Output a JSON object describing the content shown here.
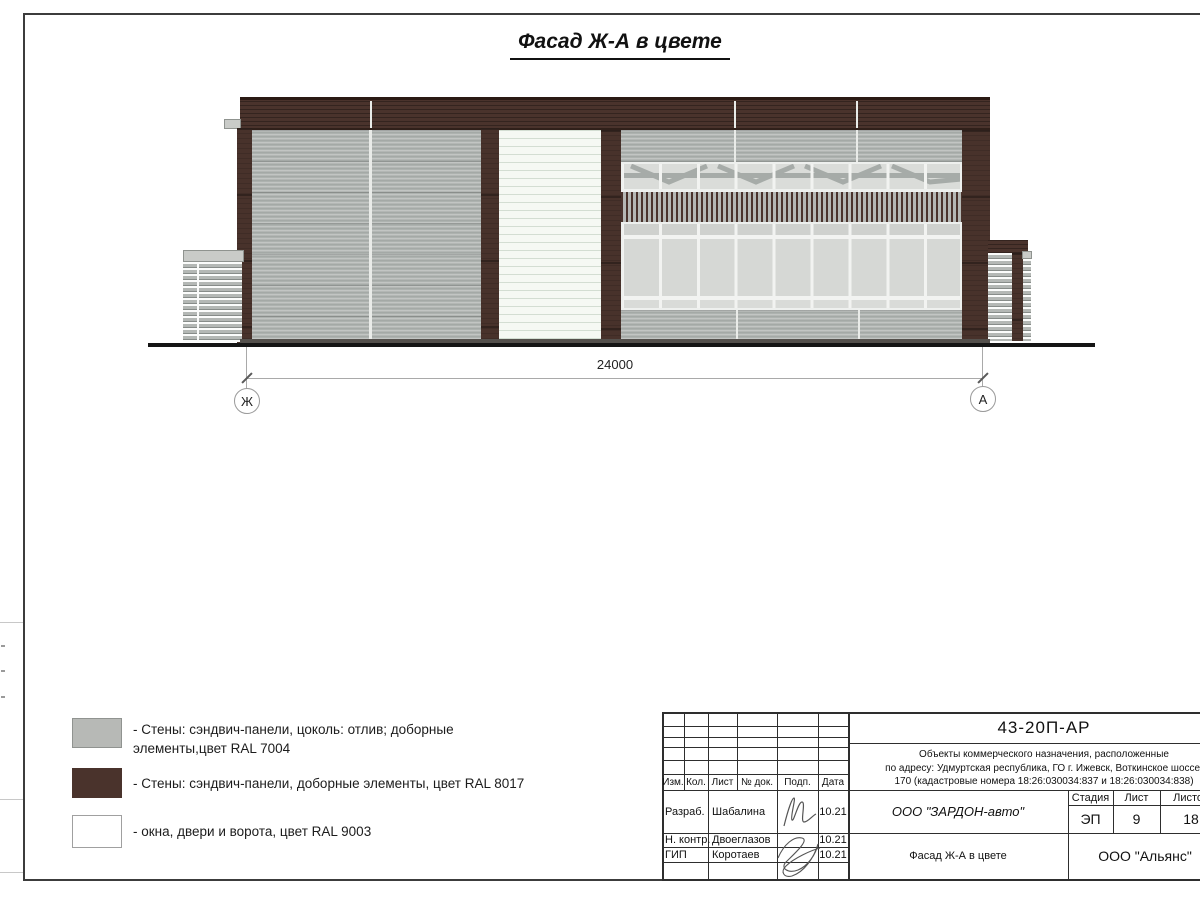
{
  "page": {
    "title": "Фасад Ж-А в цвете"
  },
  "drawing": {
    "dimension": {
      "value": "24000"
    },
    "axes": {
      "left": "Ж",
      "right": "А"
    }
  },
  "legend": {
    "items": [
      {
        "id": "ral7004",
        "swatch": "#b7b9b6",
        "lines": [
          "- Стены: сэндвич-панели, цоколь: отлив; доборные",
          "элементы,цвет RAL 7004"
        ]
      },
      {
        "id": "ral8017",
        "swatch": "#4a332c",
        "lines": [
          "- Стены: сэндвич-панели, доборные элементы, цвет RAL 8017"
        ]
      },
      {
        "id": "ral9003",
        "swatch": "#ffffff",
        "lines": [
          "- окна, двери и ворота, цвет RAL 9003"
        ]
      }
    ]
  },
  "title_block": {
    "doc_code": "43-20П-АР",
    "description": {
      "line1": "Объекты коммерческого назначения, расположенные",
      "line2": "по адресу: Удмуртская республика, ГО г. Ижевск, Воткинское шоссе,",
      "line3": "170 (кадастровые номера 18:26:030034:837 и 18:26:030034:838)"
    },
    "columns": {
      "c1": "Изм.",
      "c2": "Кол.",
      "c3": "Лист",
      "c4": "№ док.",
      "c5": "Подп.",
      "c6": "Дата"
    },
    "signers": {
      "r1": {
        "role": "Разраб.",
        "name": "Шабалина",
        "date": "10.21"
      },
      "r2": {
        "role": "Н. контр.",
        "name": "Двоеглазов",
        "date": "10.21"
      },
      "r3": {
        "role": "ГИП",
        "name": "Коротаев",
        "date": "10.21"
      }
    },
    "stage": {
      "h1": "Стадия",
      "h2": "Лист",
      "h3": "Листов",
      "v1": "ЭП",
      "v2": "9",
      "v3": "18"
    },
    "client": "ООО \"ЗАРДОН-авто\"",
    "sheet_name": "Фасад Ж-А в цвете",
    "company": "ООО \"Альянс\""
  },
  "colors": {
    "ral7004_gray": "#adb2af",
    "ral8017_brown": "#4a332c",
    "ral9003_white": "#f5f8f3"
  }
}
